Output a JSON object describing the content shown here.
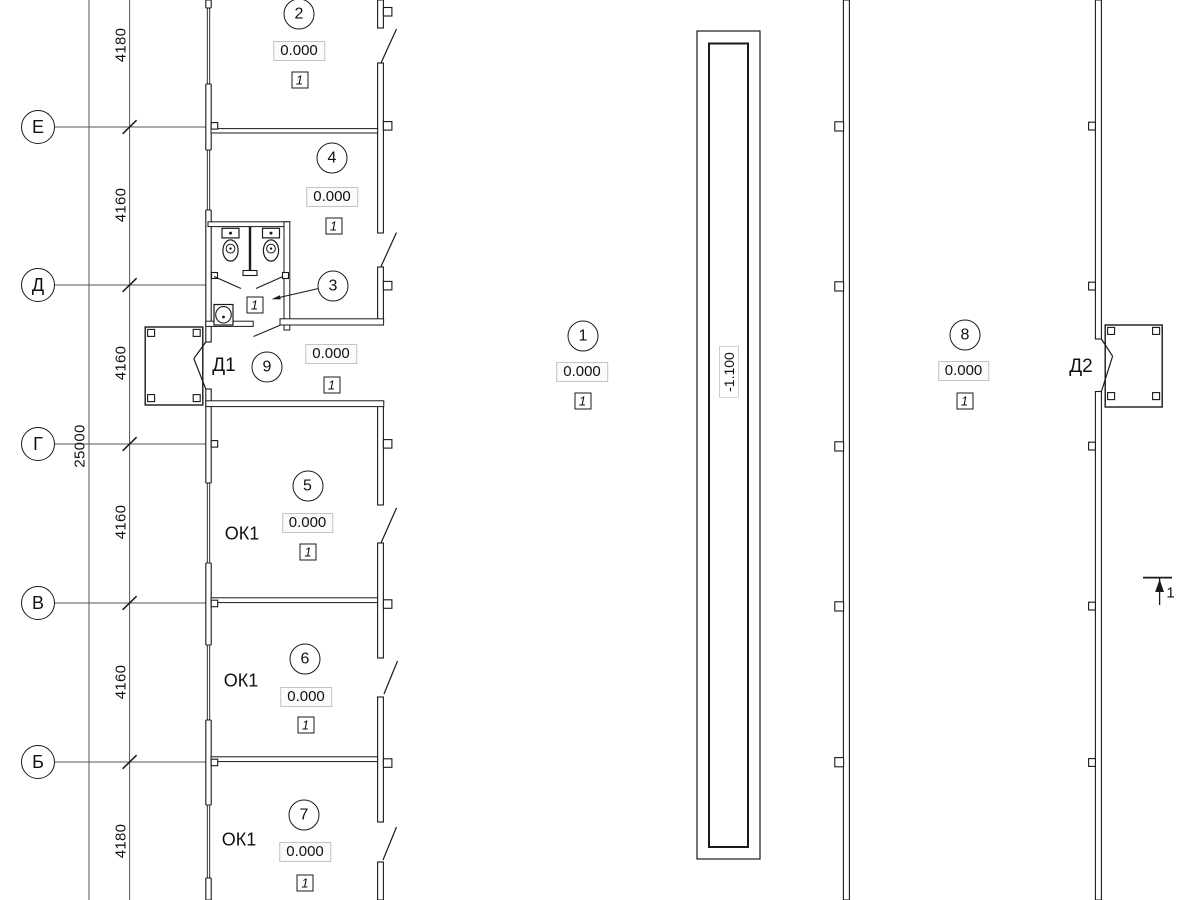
{
  "axes": [
    {
      "label": "Е"
    },
    {
      "label": "Д"
    },
    {
      "label": "Г"
    },
    {
      "label": "В"
    },
    {
      "label": "Б"
    }
  ],
  "dimensions": {
    "segments": [
      {
        "value": "4180"
      },
      {
        "value": "4160"
      },
      {
        "value": "4160"
      },
      {
        "value": "4160"
      },
      {
        "value": "4160"
      },
      {
        "value": "4180"
      }
    ],
    "total": {
      "value": "25000"
    }
  },
  "rooms": {
    "r1": {
      "number": "1",
      "elevation": "0.000",
      "finish": "1"
    },
    "r2": {
      "number": "2",
      "elevation": "0.000",
      "finish": "1"
    },
    "r3": {
      "number": "3",
      "finish": "1"
    },
    "r4": {
      "number": "4",
      "elevation": "0.000",
      "finish": "1"
    },
    "r5": {
      "number": "5",
      "elevation": "0.000",
      "finish": "1",
      "window": "ОК1"
    },
    "r6": {
      "number": "6",
      "elevation": "0.000",
      "finish": "1",
      "window": "ОК1"
    },
    "r7": {
      "number": "7",
      "elevation": "0.000",
      "finish": "1",
      "window": "ОК1"
    },
    "r8": {
      "number": "8",
      "elevation": "0.000",
      "finish": "1"
    },
    "r9": {
      "number": "9",
      "elevation": "0.000",
      "finish": "1"
    }
  },
  "doors": {
    "d1": {
      "label": "Д1"
    },
    "d2": {
      "label": "Д2"
    }
  },
  "pit": {
    "elevation": "-1.100"
  },
  "section": {
    "label": "1"
  }
}
